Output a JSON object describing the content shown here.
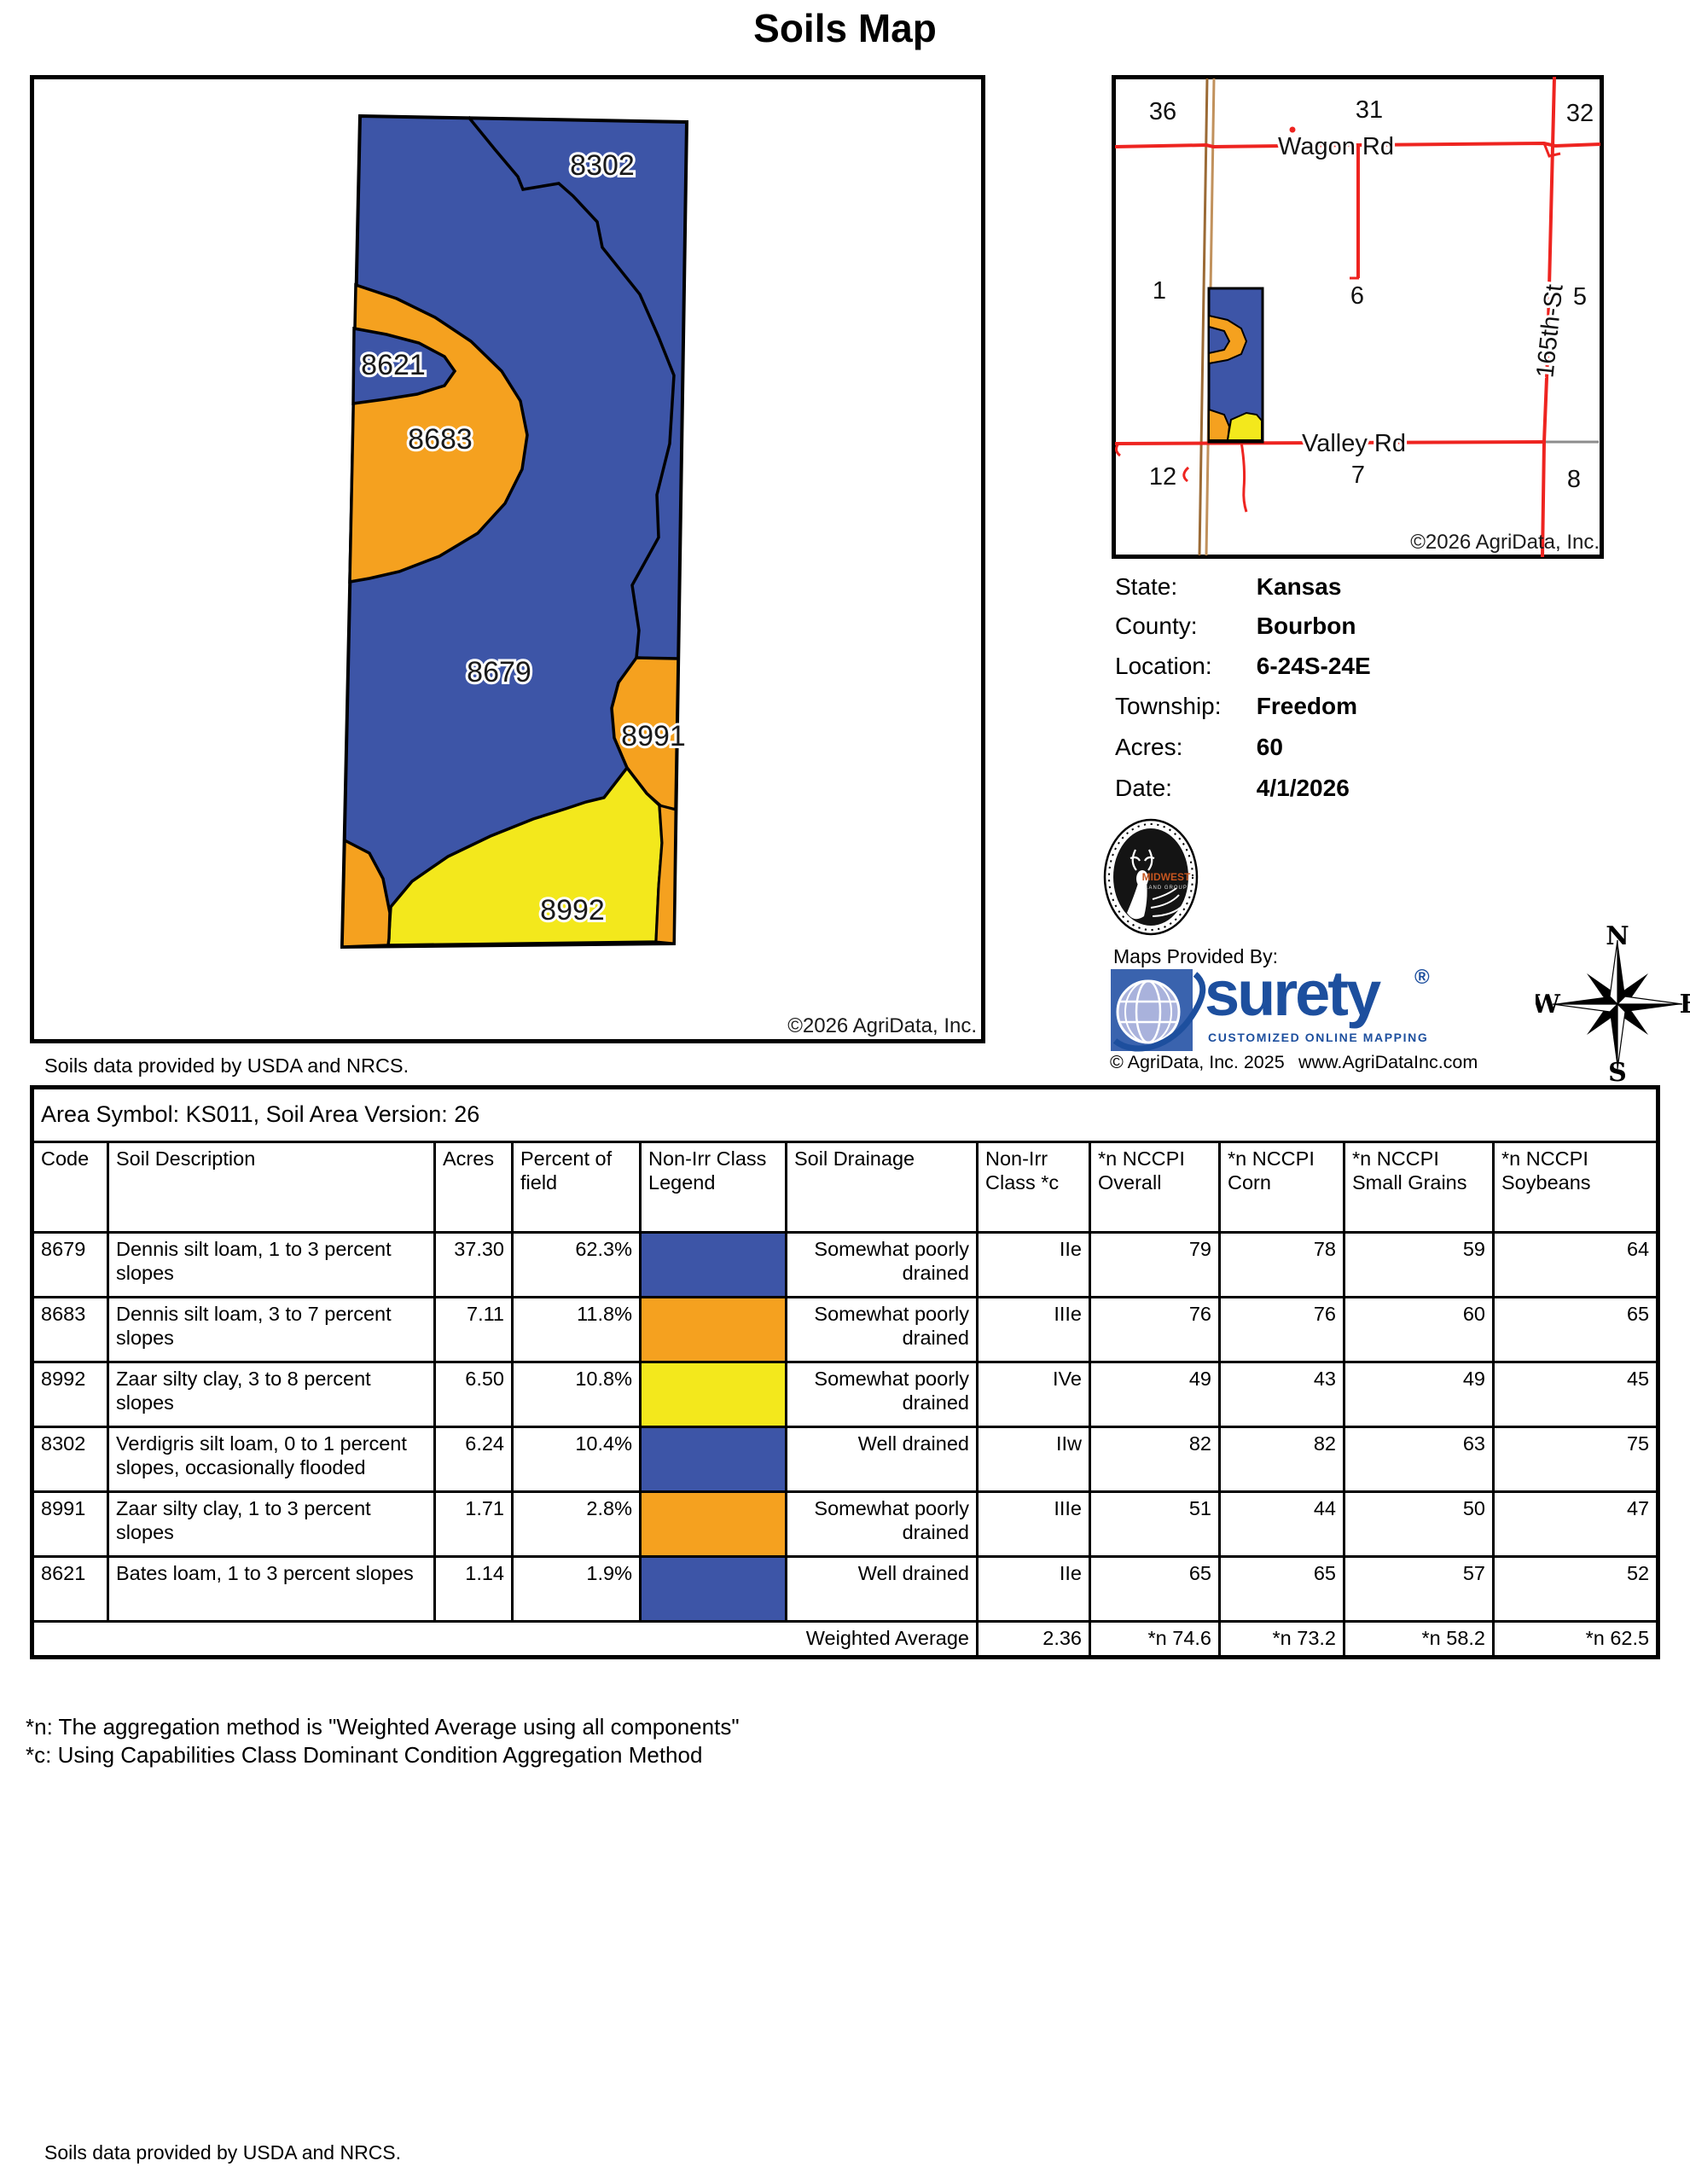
{
  "title": "Soils Map",
  "colors": {
    "soil_blue": "#3D55A7",
    "soil_orange": "#F5A11F",
    "soil_yellow": "#F3E81C",
    "road_red": "#EE2420",
    "road_gray": "#8C8C8C",
    "rail_brown": "#9B6A35",
    "rail_tan": "#C1915C",
    "surety_blue": "#1D4F9E",
    "globe_bg": "#3A63AE",
    "globe_sphere": "#A9B2DC"
  },
  "map": {
    "labels": [
      "8302",
      "8621",
      "8683",
      "8679",
      "8991",
      "8992"
    ],
    "copyright": "©2026 AgriData, Inc.",
    "source_note": "Soils data provided by USDA and NRCS."
  },
  "locator": {
    "sections": [
      "36",
      "31",
      "32",
      "1",
      "6",
      "5",
      "12",
      "7",
      "8"
    ],
    "roads": {
      "wagon": "Wagon Rd",
      "valley": "Valley Rd",
      "street": "165th-St"
    },
    "copyright": "©2026 AgriData, Inc."
  },
  "info": {
    "rows": [
      {
        "label": "State:",
        "value": "Kansas"
      },
      {
        "label": "County:",
        "value": "Bourbon"
      },
      {
        "label": "Location:",
        "value": "6-24S-24E"
      },
      {
        "label": "Township:",
        "value": "Freedom"
      },
      {
        "label": "Acres:",
        "value": "60"
      },
      {
        "label": "Date:",
        "value": "4/1/2026"
      }
    ]
  },
  "branding": {
    "maps_provided_by": "Maps Provided By:",
    "surety": "surety",
    "reg": "®",
    "tagline": "CUSTOMIZED ONLINE MAPPING",
    "agridata_copyright": "© AgriData, Inc. 2025",
    "website": "www.AgriDataInc.com",
    "midwest_line1": "MIDWEST",
    "midwest_line2": "LAND GROUP"
  },
  "compass": {
    "n": "N",
    "e": "E",
    "s": "S",
    "w": "W"
  },
  "table": {
    "area_symbol_line": "Area Symbol: KS011, Soil Area Version: 26",
    "columns": [
      "Code",
      "Soil Description",
      "Acres",
      "Percent of field",
      "Non-Irr Class Legend",
      "Soil Drainage",
      "Non-Irr Class *c",
      "*n NCCPI Overall",
      "*n NCCPI Corn",
      "*n NCCPI Small Grains",
      "*n NCCPI Soybeans"
    ],
    "rows": [
      {
        "code": "8679",
        "description": "Dennis silt loam, 1 to 3 percent slopes",
        "acres": "37.30",
        "percent": "62.3%",
        "legend_color": "#3D55A7",
        "drainage": "Somewhat poorly drained",
        "nonirr_class": "IIe",
        "overall": "79",
        "corn": "78",
        "small_grains": "59",
        "soybeans": "64"
      },
      {
        "code": "8683",
        "description": "Dennis silt loam, 3 to 7 percent slopes",
        "acres": "7.11",
        "percent": "11.8%",
        "legend_color": "#F5A11F",
        "drainage": "Somewhat poorly drained",
        "nonirr_class": "IIIe",
        "overall": "76",
        "corn": "76",
        "small_grains": "60",
        "soybeans": "65"
      },
      {
        "code": "8992",
        "description": "Zaar silty clay, 3 to 8 percent slopes",
        "acres": "6.50",
        "percent": "10.8%",
        "legend_color": "#F3E81C",
        "drainage": "Somewhat poorly drained",
        "nonirr_class": "IVe",
        "overall": "49",
        "corn": "43",
        "small_grains": "49",
        "soybeans": "45"
      },
      {
        "code": "8302",
        "description": "Verdigris silt loam, 0 to 1 percent slopes, occasionally flooded",
        "acres": "6.24",
        "percent": "10.4%",
        "legend_color": "#3D55A7",
        "drainage": "Well drained",
        "nonirr_class": "IIw",
        "overall": "82",
        "corn": "82",
        "small_grains": "63",
        "soybeans": "75"
      },
      {
        "code": "8991",
        "description": "Zaar silty clay, 1 to 3 percent slopes",
        "acres": "1.71",
        "percent": "2.8%",
        "legend_color": "#F5A11F",
        "drainage": "Somewhat poorly drained",
        "nonirr_class": "IIIe",
        "overall": "51",
        "corn": "44",
        "small_grains": "50",
        "soybeans": "47"
      },
      {
        "code": "8621",
        "description": "Bates loam, 1 to 3 percent slopes",
        "acres": "1.14",
        "percent": "1.9%",
        "legend_color": "#3D55A7",
        "drainage": "Well drained",
        "nonirr_class": "IIe",
        "overall": "65",
        "corn": "65",
        "small_grains": "57",
        "soybeans": "52"
      }
    ],
    "weighted_average": {
      "label": "Weighted Average",
      "nonirr_class": "2.36",
      "overall": "*n 74.6",
      "corn": "*n 73.2",
      "small_grains": "*n 58.2",
      "soybeans": "*n 62.5"
    }
  },
  "footnotes": [
    "*n: The aggregation method is \"Weighted Average using all components\"",
    "*c: Using Capabilities Class Dominant Condition Aggregation Method"
  ],
  "footer": "Soils data provided by USDA and NRCS."
}
